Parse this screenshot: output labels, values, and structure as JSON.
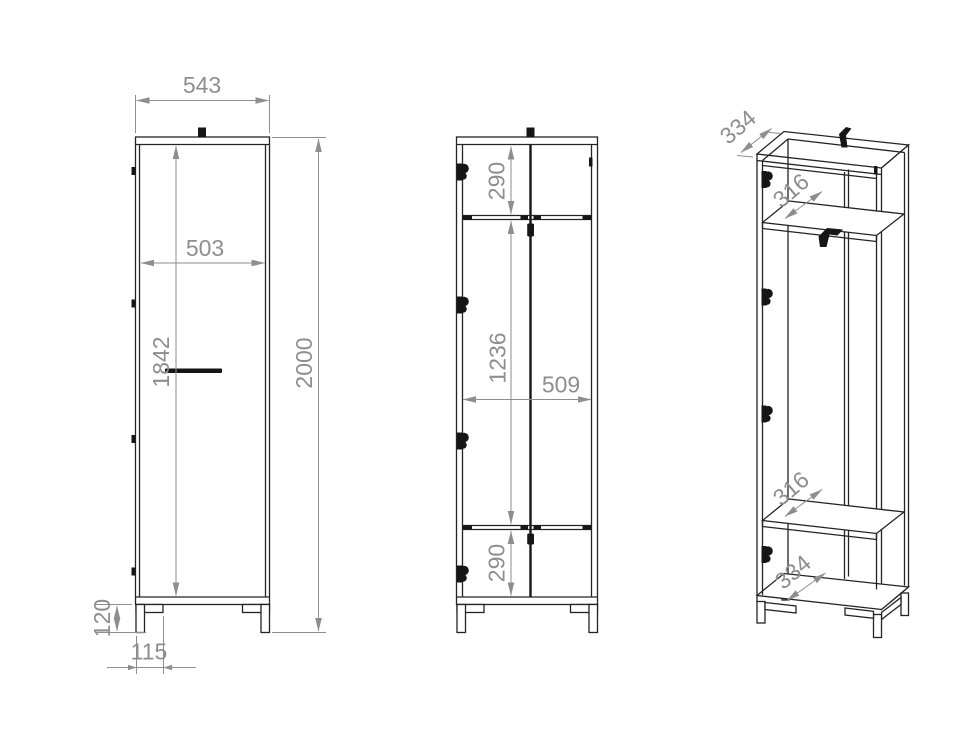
{
  "colors": {
    "background": "#ffffff",
    "line": "#242424",
    "dimension": "#8e8e8e",
    "fitting_black": "#161616"
  },
  "views": {
    "front": {
      "dims": {
        "total_width": "543",
        "door_width": "503",
        "door_height": "1842",
        "total_height": "2000",
        "leg_height": "120",
        "leg_inset": "115"
      }
    },
    "carcass": {
      "dims": {
        "top_compartment_height": "290",
        "middle_compartment_height": "1236",
        "inner_width": "509",
        "bottom_compartment_height": "290"
      }
    },
    "perspective": {
      "dims": {
        "top_depth": "334",
        "upper_shelf_depth": "316",
        "lower_shelf_depth": "316",
        "bottom_shelf_depth": "334"
      }
    }
  }
}
